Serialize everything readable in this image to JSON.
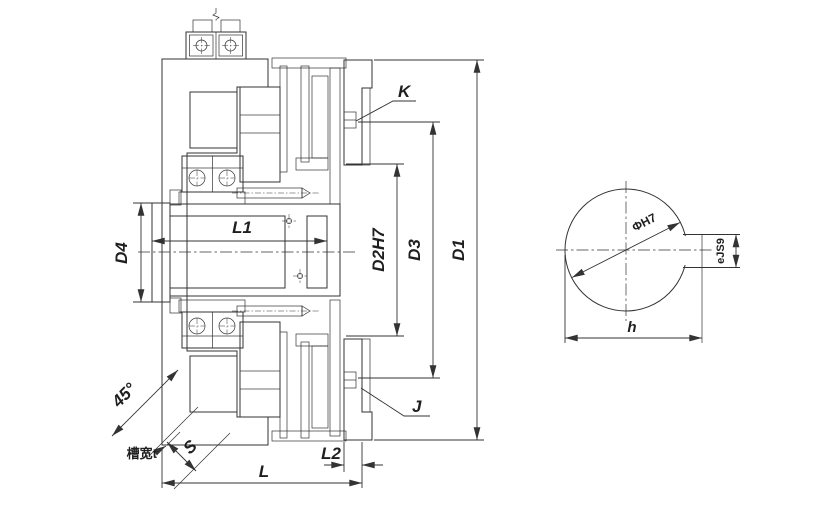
{
  "colors": {
    "line": "#333333",
    "background": "#ffffff"
  },
  "labels": {
    "d4": "D4",
    "l1": "L1",
    "d2h7": "D2H7",
    "d3": "D3",
    "d1": "D1",
    "k": "K",
    "j": "J",
    "l2": "L2",
    "l": "L",
    "s": "S",
    "angle45": "45°",
    "slot_width": "槽宽t"
  },
  "detail": {
    "bore_dia": "ΦH7",
    "key_width": "eJS9",
    "key_height": "h"
  }
}
